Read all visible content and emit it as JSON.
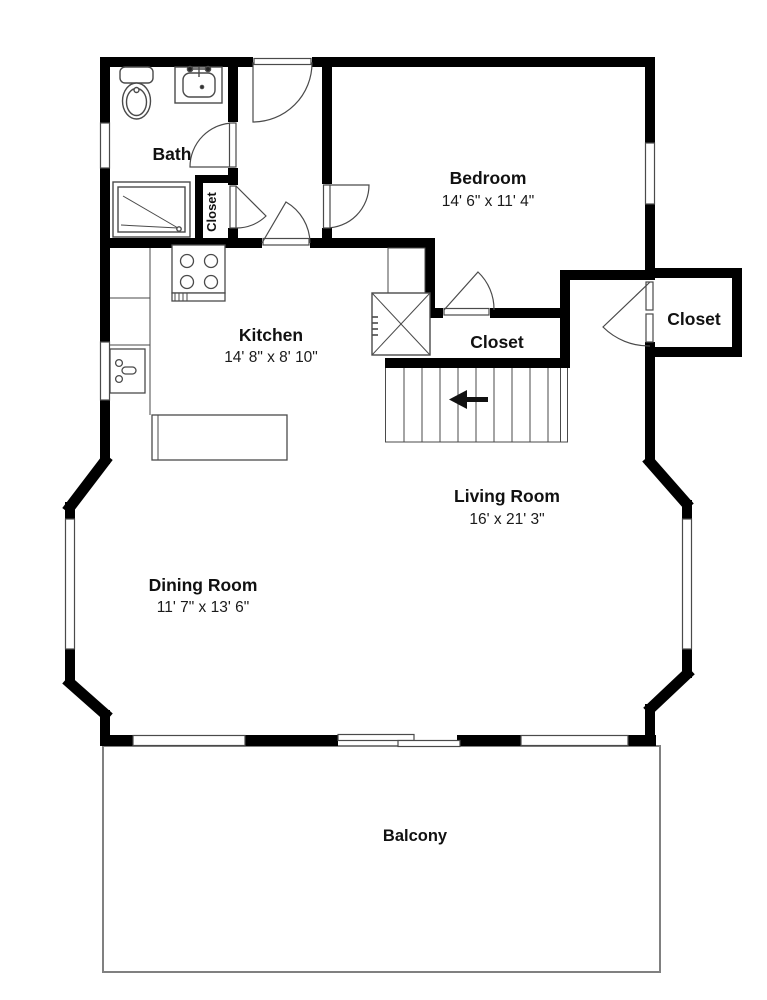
{
  "plan": {
    "type": "floor-plan",
    "colors": {
      "wall": "#000000",
      "thin_line": "#4a4a4a",
      "balcony_line": "#808080",
      "text": "#111111",
      "background": "#ffffff"
    },
    "rooms": {
      "bath": {
        "name": "Bath"
      },
      "bath_closet": {
        "name": "Closet"
      },
      "bedroom": {
        "name": "Bedroom",
        "dims": "14' 6\" x 11' 4\""
      },
      "kitchen": {
        "name": "Kitchen",
        "dims": "14' 8\" x 8' 10\""
      },
      "hall_closet": {
        "name": "Closet"
      },
      "entry_closet": {
        "name": "Closet"
      },
      "living_room": {
        "name": "Living Room",
        "dims": "16' x 21' 3\""
      },
      "dining_room": {
        "name": "Dining Room",
        "dims": "11' 7\" x 13' 6\""
      },
      "balcony": {
        "name": "Balcony"
      }
    }
  }
}
